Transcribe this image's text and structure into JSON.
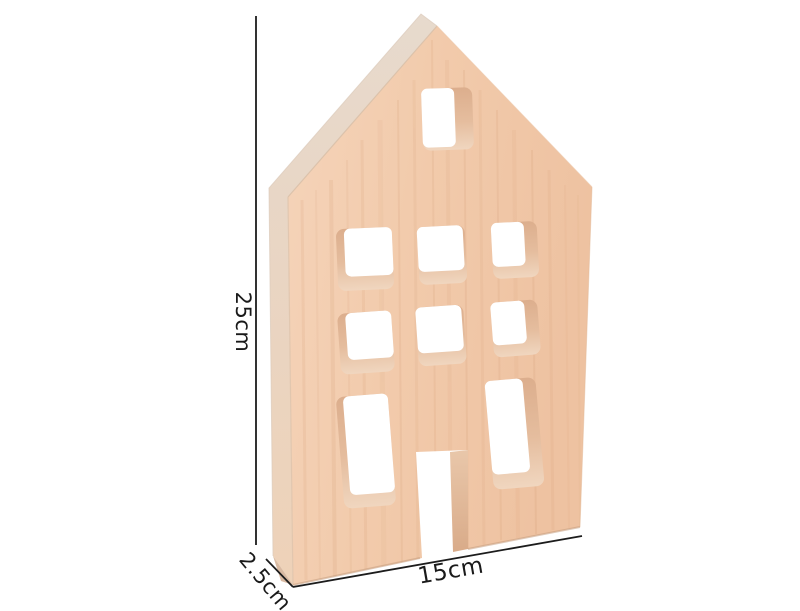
{
  "annotations": {
    "height": "25cm",
    "width": "15cm",
    "depth": "2.5cm"
  },
  "colors": {
    "background": "#ffffff",
    "dimension_line": "#1c1c1c",
    "text": "#1a1a1a",
    "wood_face": "#f2cbac",
    "wood_edge": "#e9dbce",
    "wood_inner_edge": "#e3bb9c"
  }
}
